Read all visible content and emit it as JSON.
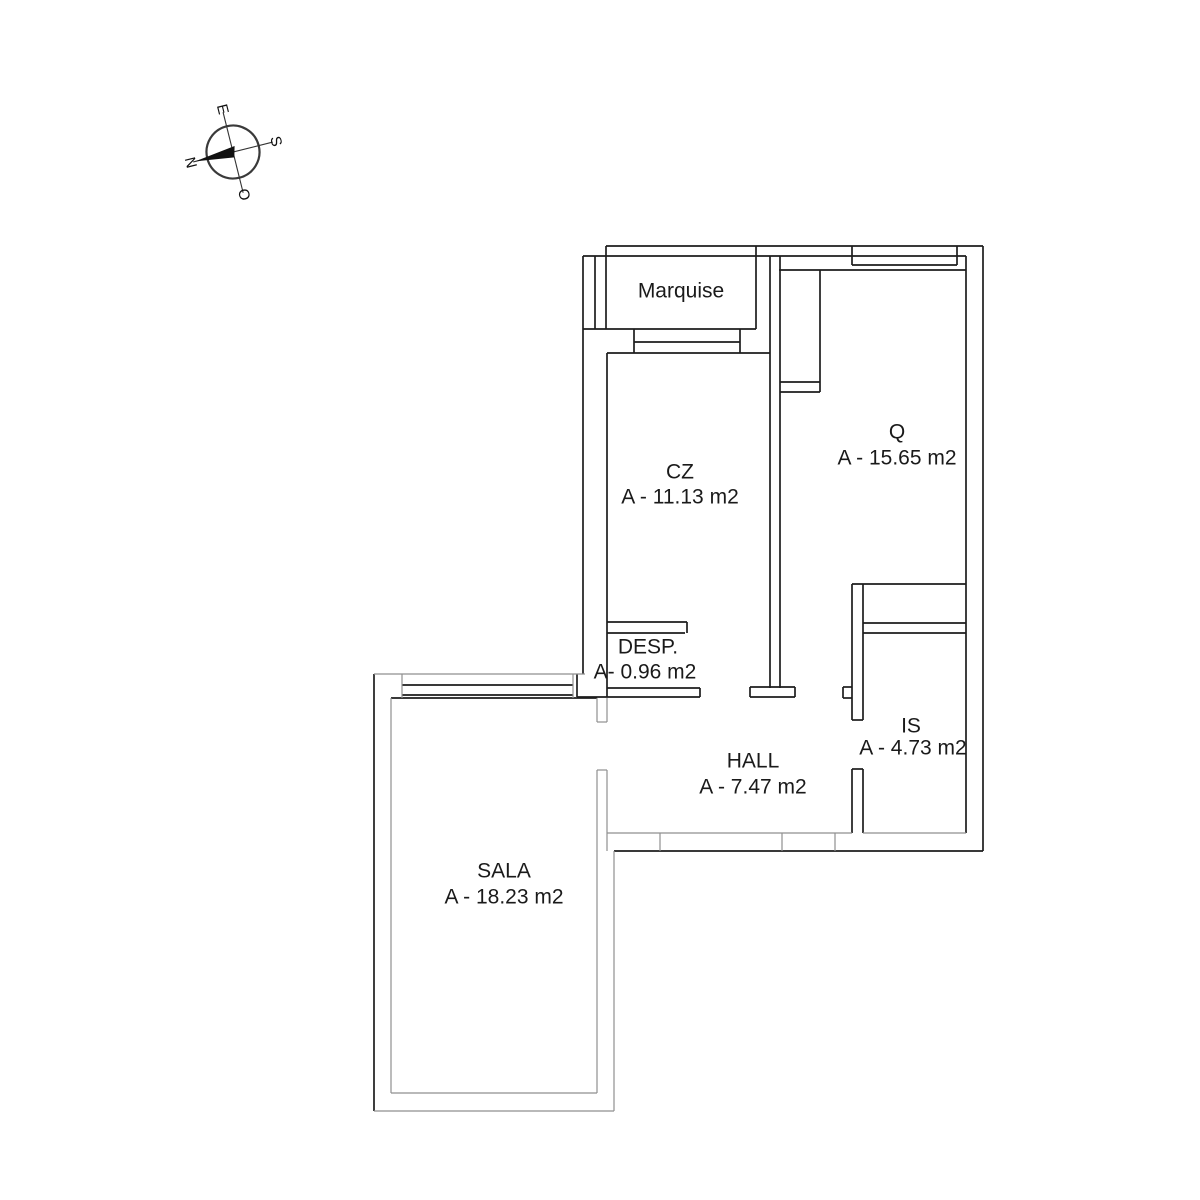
{
  "page": {
    "background": "#ffffff",
    "width": 1200,
    "height": 1200
  },
  "compass": {
    "center_x": 233,
    "center_y": 152,
    "radius": 26.5,
    "rotation_deg": -14,
    "letters": {
      "top": "E",
      "right": "S",
      "bottom": "O",
      "left": "N"
    }
  },
  "plan": {
    "wall_color": "#1d1d1d",
    "soft_color": "#8f8f8f",
    "label_color": "#1a1a1a",
    "walls_black": [
      [
        606,
        246,
        983,
        246
      ],
      [
        583,
        256,
        966,
        256
      ],
      [
        779,
        270,
        966,
        270
      ],
      [
        583,
        329,
        756,
        329
      ],
      [
        634,
        342,
        740,
        342
      ],
      [
        607,
        353,
        770,
        353
      ],
      [
        852,
        584,
        966,
        584
      ],
      [
        863,
        623,
        966,
        623
      ],
      [
        607,
        622,
        687,
        622
      ],
      [
        607,
        633,
        685,
        633
      ],
      [
        863,
        633,
        966,
        633
      ],
      [
        607,
        688,
        700,
        688
      ],
      [
        577,
        697,
        700,
        697
      ],
      [
        750,
        687,
        795,
        687
      ],
      [
        750,
        697,
        795,
        697
      ],
      [
        843,
        687,
        852,
        687
      ],
      [
        843,
        698,
        852,
        698
      ],
      [
        402,
        685,
        573,
        685
      ],
      [
        402,
        695,
        573,
        695
      ],
      [
        391,
        698,
        597,
        698
      ],
      [
        614,
        851,
        983,
        851
      ],
      [
        852,
        265,
        957,
        265
      ],
      [
        780,
        382,
        820,
        382
      ],
      [
        780,
        392,
        820,
        392
      ],
      [
        852,
        720,
        863,
        720
      ],
      [
        852,
        769,
        863,
        769
      ],
      [
        583,
        256,
        583,
        674
      ],
      [
        595,
        256,
        595,
        329
      ],
      [
        606,
        246,
        606,
        329
      ],
      [
        756,
        246,
        756,
        329
      ],
      [
        634,
        329,
        634,
        353
      ],
      [
        740,
        329,
        740,
        353
      ],
      [
        607,
        353,
        607,
        697
      ],
      [
        770,
        256,
        770,
        688
      ],
      [
        780,
        256,
        780,
        688
      ],
      [
        820,
        270,
        820,
        392
      ],
      [
        687,
        622,
        687,
        633
      ],
      [
        700,
        688,
        700,
        697
      ],
      [
        750,
        687,
        750,
        697
      ],
      [
        795,
        687,
        795,
        697
      ],
      [
        843,
        687,
        843,
        698
      ],
      [
        852,
        584,
        852,
        720
      ],
      [
        863,
        584,
        863,
        720
      ],
      [
        852,
        769,
        852,
        833
      ],
      [
        863,
        769,
        863,
        833
      ],
      [
        966,
        256,
        966,
        833
      ],
      [
        983,
        246,
        983,
        851
      ],
      [
        374,
        674,
        374,
        1111
      ],
      [
        957,
        246,
        957,
        265
      ],
      [
        852,
        246,
        852,
        265
      ],
      [
        577,
        674,
        577,
        697
      ]
    ],
    "walls_gray": [
      [
        374,
        674,
        585,
        674
      ],
      [
        402,
        674,
        402,
        698
      ],
      [
        573,
        674,
        573,
        698
      ],
      [
        597,
        698,
        597,
        722
      ],
      [
        607,
        698,
        607,
        722
      ],
      [
        597,
        722,
        607,
        722
      ],
      [
        597,
        770,
        607,
        770
      ],
      [
        607,
        770,
        607,
        851
      ],
      [
        391,
        698,
        391,
        1093
      ],
      [
        391,
        1093,
        597,
        1093
      ],
      [
        597,
        770,
        597,
        1093
      ],
      [
        614,
        851,
        614,
        1111
      ],
      [
        374,
        1111,
        614,
        1111
      ],
      [
        607,
        833,
        852,
        833
      ],
      [
        863,
        833,
        966,
        833
      ],
      [
        660,
        833,
        660,
        851
      ],
      [
        782,
        833,
        782,
        851
      ],
      [
        835,
        833,
        835,
        851
      ]
    ],
    "labels": [
      {
        "id": "marquise",
        "lines": [
          {
            "text": "Marquise",
            "x": 681,
            "y": 291
          }
        ]
      },
      {
        "id": "cz",
        "lines": [
          {
            "text": "CZ",
            "x": 680,
            "y": 472
          },
          {
            "text": "A - 11.13 m2",
            "x": 680,
            "y": 497
          }
        ]
      },
      {
        "id": "q",
        "lines": [
          {
            "text": "Q",
            "x": 897,
            "y": 432
          },
          {
            "text": "A - 15.65 m2",
            "x": 897,
            "y": 458
          }
        ]
      },
      {
        "id": "desp",
        "lines": [
          {
            "text": "DESP.",
            "x": 648,
            "y": 647
          },
          {
            "text": "A- 0.96 m2",
            "x": 645,
            "y": 672
          }
        ]
      },
      {
        "id": "hall",
        "lines": [
          {
            "text": "HALL",
            "x": 753,
            "y": 761
          },
          {
            "text": "A - 7.47 m2",
            "x": 753,
            "y": 787
          }
        ]
      },
      {
        "id": "is",
        "lines": [
          {
            "text": "IS",
            "x": 911,
            "y": 726
          },
          {
            "text": "A - 4.73 m2",
            "x": 913,
            "y": 748
          }
        ]
      },
      {
        "id": "sala",
        "lines": [
          {
            "text": "SALA",
            "x": 504,
            "y": 871
          },
          {
            "text": "A - 18.23 m2",
            "x": 504,
            "y": 897
          }
        ]
      }
    ]
  }
}
